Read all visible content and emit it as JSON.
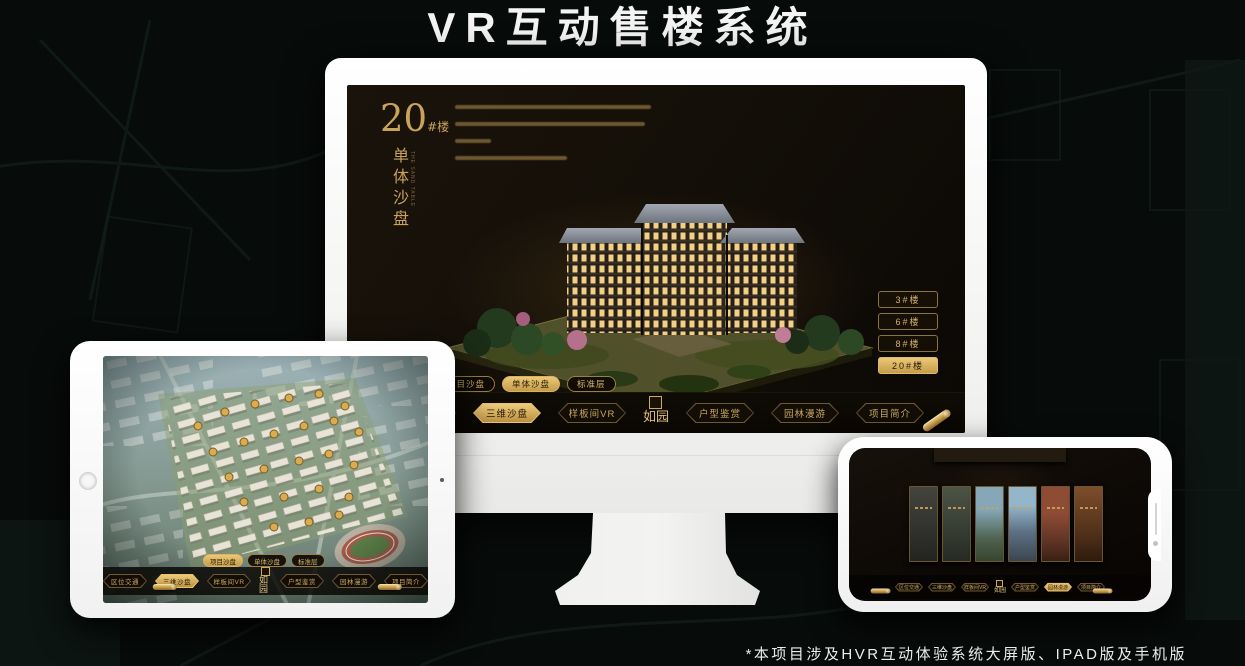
{
  "page": {
    "title": "VR互动售楼系统",
    "footnote": "*本项目涉及HVR互动体验系统大屏版、IPAD版及手机版"
  },
  "brand": {
    "logo_text": "如园",
    "gold_accent": "#d2a94f",
    "screen_background": "#140f08"
  },
  "desktop": {
    "heading_number": "20",
    "heading_unit": "#楼",
    "heading_vertical": "单体沙盘",
    "heading_en": "THE SAND TABLE",
    "tabs": [
      {
        "label": "项目沙盘",
        "active": false
      },
      {
        "label": "单体沙盘",
        "active": true
      },
      {
        "label": "标准层",
        "active": false
      }
    ],
    "floor_buttons": [
      {
        "label": "3#楼",
        "active": false
      },
      {
        "label": "6#楼",
        "active": false
      },
      {
        "label": "8#楼",
        "active": false
      },
      {
        "label": "20#楼",
        "active": true
      }
    ],
    "menu": [
      {
        "label": "区位交通",
        "active": false
      },
      {
        "label": "三维沙盘",
        "active": true
      },
      {
        "label": "样板间VR",
        "active": false
      },
      {
        "label": "户型鉴赏",
        "active": false
      },
      {
        "label": "园林漫游",
        "active": false
      },
      {
        "label": "项目简介",
        "active": false
      }
    ]
  },
  "tablet": {
    "tabs": [
      {
        "label": "项目沙盘",
        "active": true
      },
      {
        "label": "单体沙盘",
        "active": false
      },
      {
        "label": "标准层",
        "active": false
      }
    ],
    "menu": [
      {
        "label": "区位交通",
        "active": false
      },
      {
        "label": "三维沙盘",
        "active": true
      },
      {
        "label": "样板间VR",
        "active": false
      },
      {
        "label": "户型鉴赏",
        "active": false
      },
      {
        "label": "园林漫游",
        "active": false
      },
      {
        "label": "项目简介",
        "active": false
      }
    ]
  },
  "phone": {
    "menu": [
      {
        "label": "区位交通",
        "active": false
      },
      {
        "label": "三维沙盘",
        "active": false
      },
      {
        "label": "样板间VR",
        "active": false
      },
      {
        "label": "户型鉴赏",
        "active": false
      },
      {
        "label": "园林漫游",
        "active": true
      },
      {
        "label": "项目简介",
        "active": false
      }
    ]
  }
}
